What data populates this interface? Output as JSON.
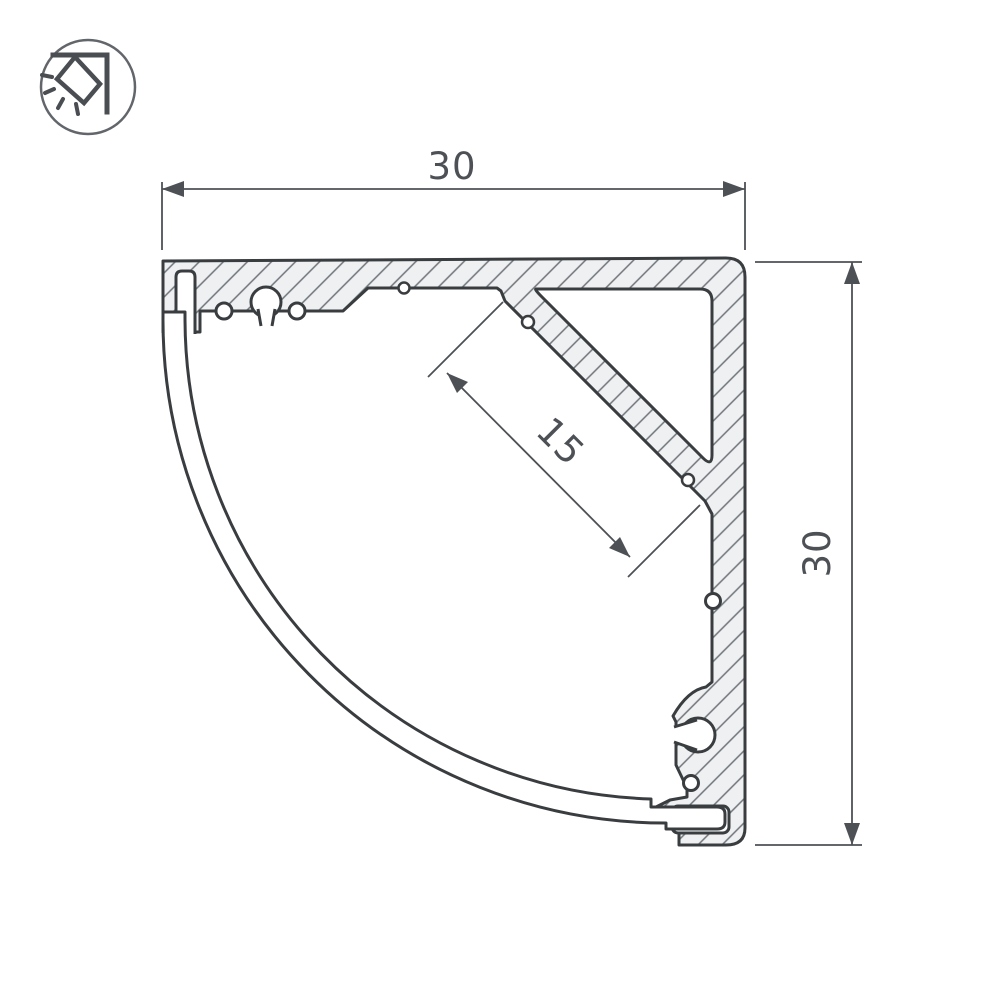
{
  "drawing": {
    "title": "corner-led-profile-cross-section",
    "dimensions": {
      "width": {
        "label": "30"
      },
      "height": {
        "label": "30"
      },
      "led_shelf": {
        "label": "15"
      }
    },
    "icon": {
      "name": "corner-mounted-light"
    },
    "colors": {
      "outline": "#3a3d40",
      "aluminum_fill": "#eef0f1",
      "hatch": "#70737a",
      "dimension": "#4d5156",
      "background": "#ffffff"
    }
  }
}
